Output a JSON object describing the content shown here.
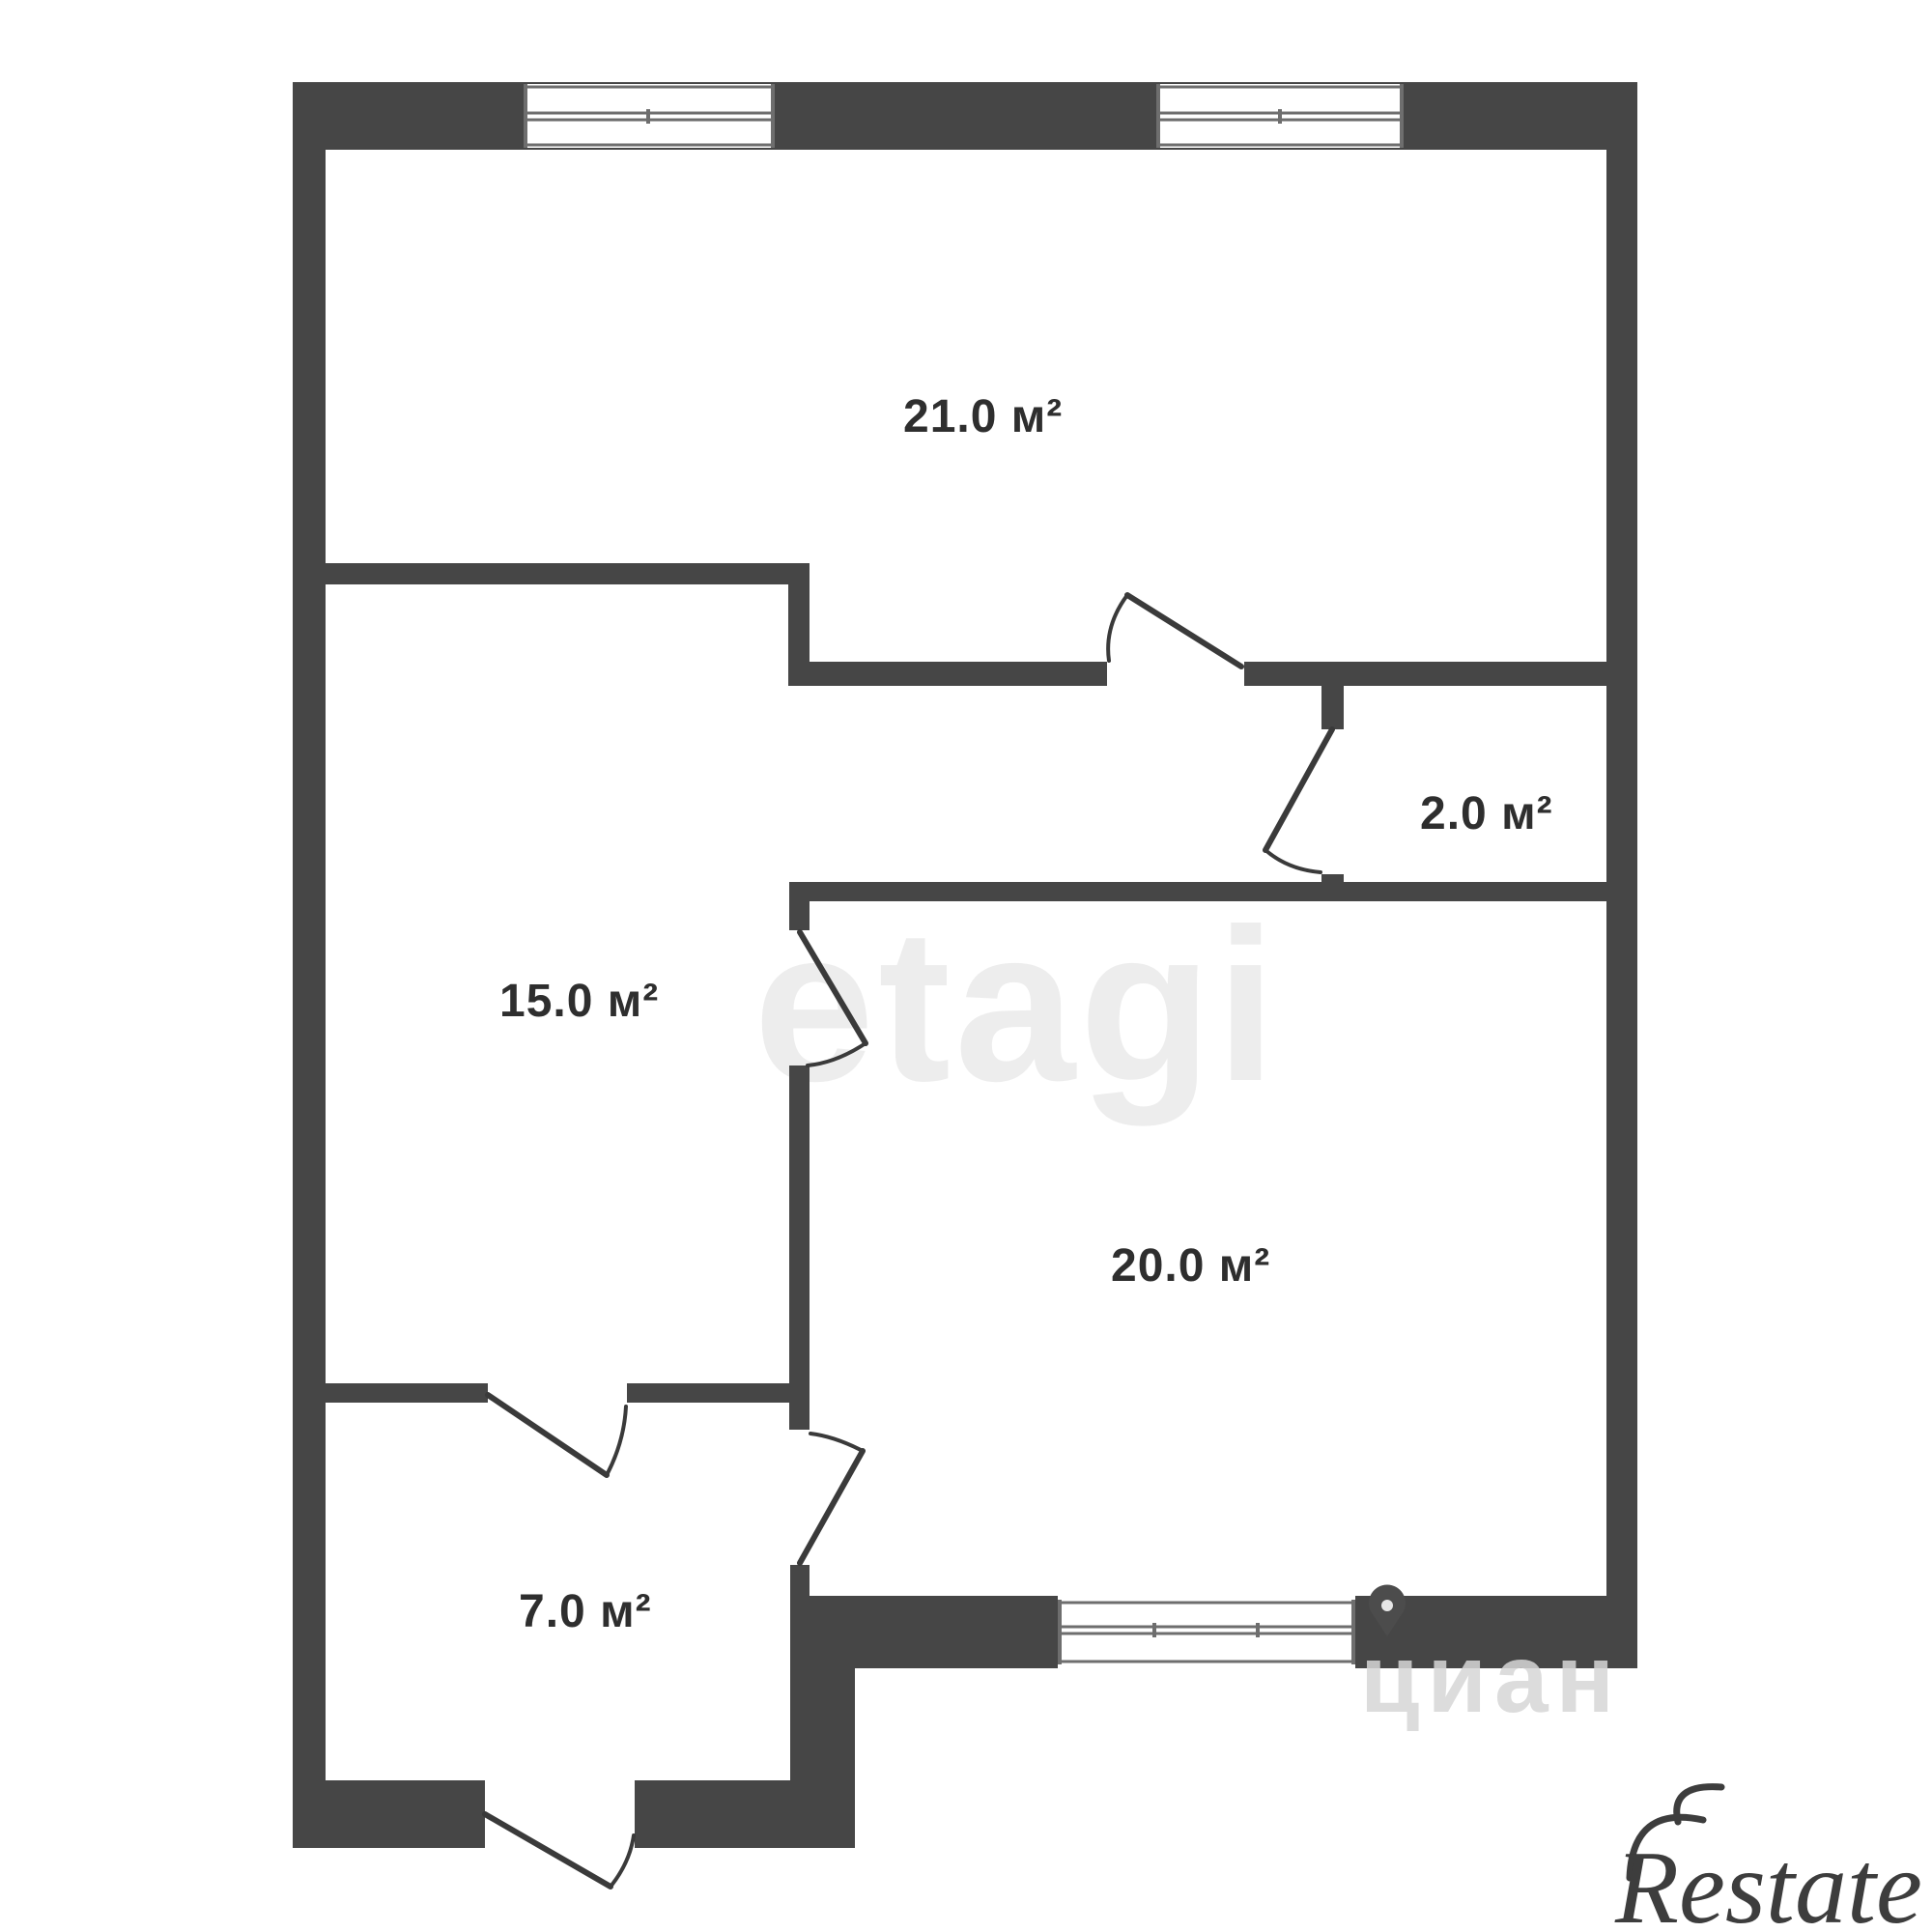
{
  "plan": {
    "unit": "м²",
    "rooms": [
      {
        "name": "room-21",
        "area_label": "21.0 м²"
      },
      {
        "name": "closet-2",
        "area_label": "2.0 м²"
      },
      {
        "name": "room-15",
        "area_label": "15.0 м²"
      },
      {
        "name": "room-20",
        "area_label": "20.0 м²"
      },
      {
        "name": "hall-7",
        "area_label": "7.0 м²"
      }
    ]
  },
  "watermarks": {
    "center_brand": "etagi",
    "corner_brand_partial": "циан",
    "logo_brand": "Restate"
  },
  "icons": {
    "cian_pin": "location-pin"
  },
  "colors": {
    "wall": "#464646",
    "room_label": "#2e2e2e",
    "window_line": "#6e6e6e",
    "watermark_center": "#ededed",
    "watermark_corner": "#d7d7d7",
    "logo": "#3d3d3d",
    "background": "#ffffff"
  }
}
